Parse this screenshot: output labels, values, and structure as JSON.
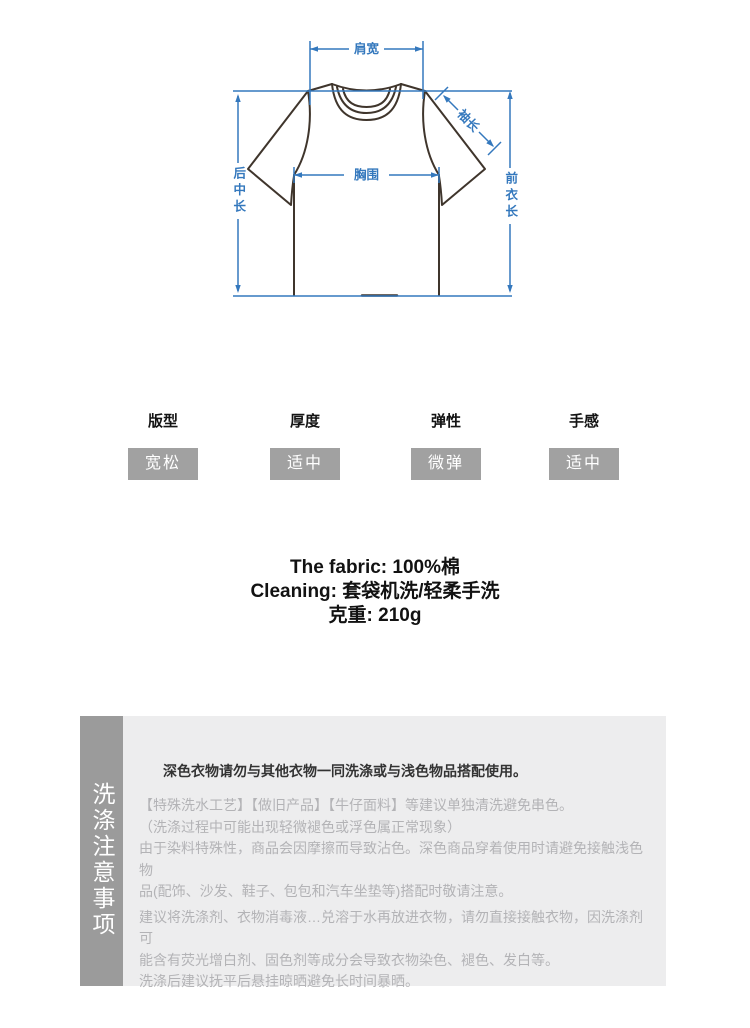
{
  "diagram": {
    "labels": {
      "shoulder": "肩宽",
      "sleeve": "袖长",
      "chest": "胸围",
      "back_length": "后中长",
      "front_length": "前衣长"
    },
    "colors": {
      "dimension_line": "#3478bd",
      "shirt_outline": "#3f352c"
    }
  },
  "attributes": {
    "items": [
      {
        "label": "版型",
        "value": "宽松"
      },
      {
        "label": "厚度",
        "value": "适中"
      },
      {
        "label": "弹性",
        "value": "微弹"
      },
      {
        "label": "手感",
        "value": "适中"
      }
    ],
    "value_box_color": "#a1a1a1"
  },
  "fabric_info": {
    "lines": [
      "The fabric: 100%棉",
      "Cleaning: 套袋机洗/轻柔手洗",
      "克重: 210g"
    ]
  },
  "care": {
    "sidebar_title": "洗涤注意事项",
    "heading": "深色衣物请勿与其他衣物一同洗涤或与浅色物品搭配使用。",
    "paragraph1_lines": [
      "【特殊洗水工艺】【做旧产品】【牛仔面料】等建议单独清洗避免串色。",
      "（洗涤过程中可能出现轻微褪色或浮色属正常现象）",
      "由于染料特殊性，商品会因摩擦而导致沾色。深色商品穿着使用时请避免接触浅色物",
      "品(配饰、沙发、鞋子、包包和汽车坐垫等)搭配时敬请注意。"
    ],
    "paragraph2_lines": [
      "建议将洗涤剂、衣物消毒液…兑溶于水再放进衣物，请勿直接接触衣物，因洗涤剂可",
      "能含有荧光增白剂、固色剂等成分会导致衣物染色、褪色、发白等。",
      "洗涤后建议抚平后悬挂晾晒避免长时间暴晒。"
    ],
    "sidebar_color": "#9b9b9b",
    "panel_color": "#ededee"
  }
}
